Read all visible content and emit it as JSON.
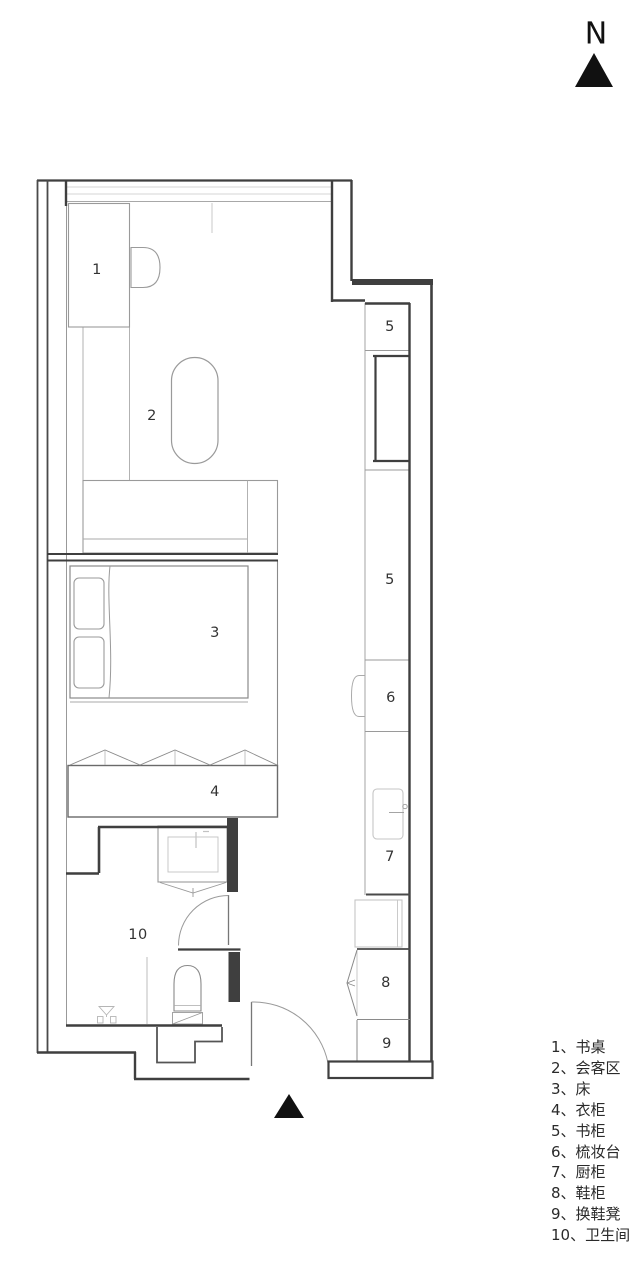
{
  "compass": {
    "label": "N"
  },
  "plan_labels": {
    "desk": "1",
    "lounge": "2",
    "bed": "3",
    "wardrobe": "4",
    "bookcase_top": "5",
    "bookcase_main": "5",
    "dresser": "6",
    "kitchen_cabinet": "7",
    "shoe_cabinet": "8",
    "shoe_stool": "9",
    "bathroom": "10"
  },
  "legend": {
    "items": [
      "1、书桌",
      "2、会客区",
      "3、床",
      "4、衣柜",
      "5、书柜",
      "6、梳妆台",
      "7、厨柜",
      "8、鞋柜",
      "9、换鞋凳",
      "10、卫生间"
    ]
  },
  "colors": {
    "wall": "#3f3f3f",
    "furniture_line": "#9a9a9a",
    "fixture_light": "#c2c2c2",
    "label_text": "#333333",
    "north_black": "#111111",
    "background": "#ffffff"
  }
}
